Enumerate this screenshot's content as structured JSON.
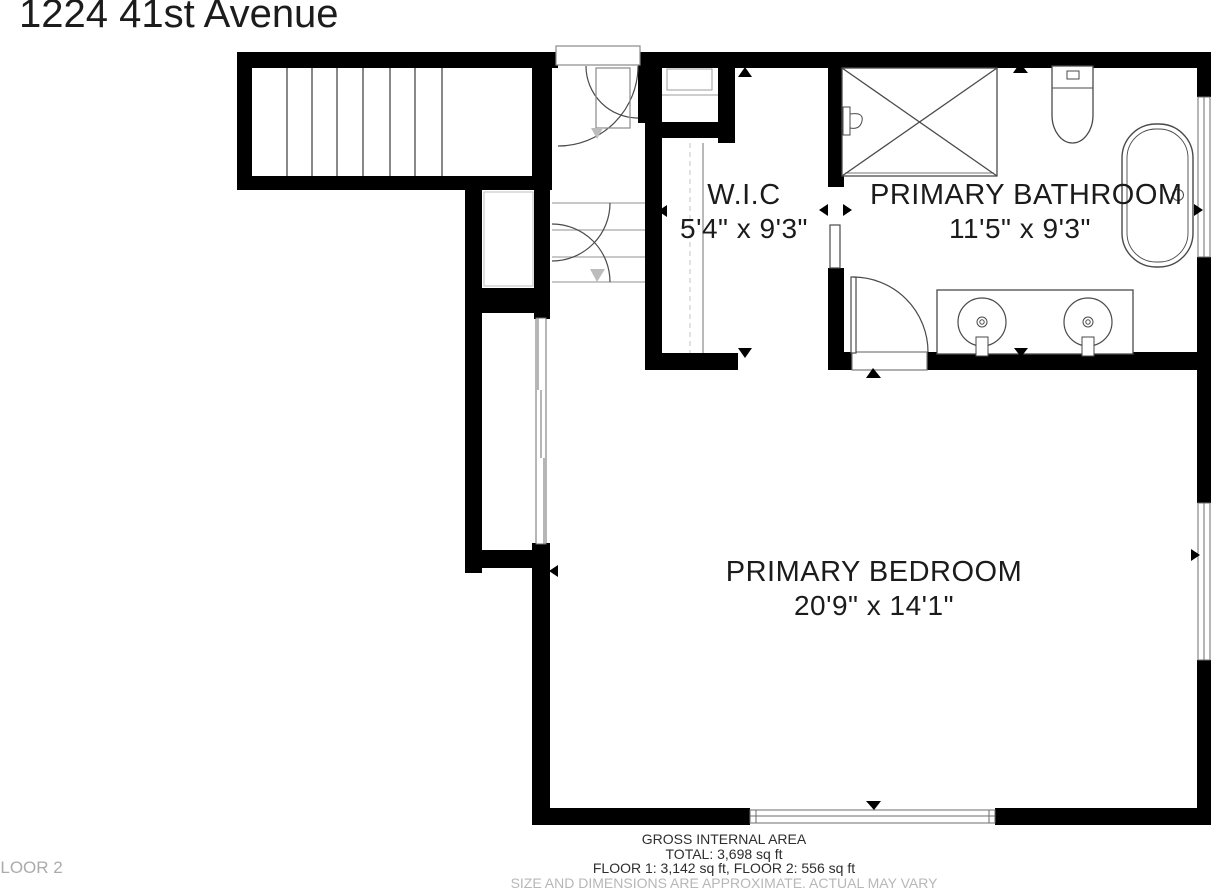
{
  "title": "1224 41st Avenue",
  "floor_label": "FLOOR 2",
  "rooms": [
    {
      "name": "W.I.C",
      "dimensions": "5'4\" x 9'3\""
    },
    {
      "name": "PRIMARY BATHROOM",
      "dimensions": "11'5\" x 9'3\""
    },
    {
      "name": "PRIMARY BEDROOM",
      "dimensions": "20'9\" x 14'1\""
    }
  ],
  "footer": {
    "line1": "GROSS INTERNAL AREA",
    "line2": "TOTAL: 3,698 sq ft",
    "line3": "FLOOR 1: 3,142 sq ft, FLOOR 2: 556 sq ft",
    "disclaimer": "SIZE AND DIMENSIONS ARE APPROXIMATE. ACTUAL MAY VARY"
  },
  "colors": {
    "wall": "#000000",
    "fixture_line": "#4a4a4a",
    "light_line": "#9c9c9c",
    "stair_arrow": "#bcbcbc",
    "disclaimer_text": "#b7b7b7"
  }
}
